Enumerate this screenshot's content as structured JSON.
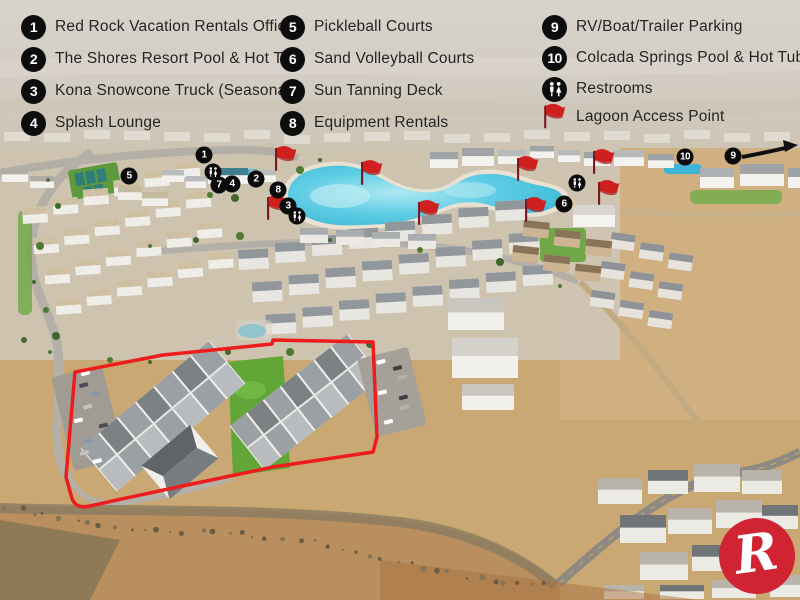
{
  "legend": {
    "items": [
      {
        "num": "1",
        "label": "Red Rock Vacation Rentals Office"
      },
      {
        "num": "2",
        "label": "The Shores Resort Pool & Hot Tub"
      },
      {
        "num": "3",
        "label": "Kona Snowcone Truck (Seasonal)"
      },
      {
        "num": "4",
        "label": "Splash Lounge"
      },
      {
        "num": "5",
        "label": "Pickleball Courts"
      },
      {
        "num": "6",
        "label": "Sand Volleyball Courts"
      },
      {
        "num": "7",
        "label": "Sun Tanning Deck"
      },
      {
        "num": "8",
        "label": "Equipment Rentals"
      },
      {
        "num": "9",
        "label": "RV/Boat/Trailer Parking"
      },
      {
        "num": "10",
        "label": "Colcada Springs Pool & Hot Tubs"
      },
      {
        "icon": "restroom",
        "label": "Restrooms"
      },
      {
        "icon": "flag",
        "label": "Lagoon Access Point"
      }
    ]
  },
  "map": {
    "markers": [
      {
        "label": "1",
        "x": 204,
        "y": 155
      },
      {
        "label": "2",
        "x": 256,
        "y": 179
      },
      {
        "label": "3",
        "x": 288,
        "y": 206
      },
      {
        "label": "4",
        "x": 232,
        "y": 184
      },
      {
        "label": "5",
        "x": 129,
        "y": 176
      },
      {
        "label": "6",
        "x": 564,
        "y": 204
      },
      {
        "label": "7",
        "x": 219,
        "y": 185
      },
      {
        "label": "8",
        "x": 278,
        "y": 190
      },
      {
        "label": "9",
        "x": 733,
        "y": 156
      },
      {
        "label": "10",
        "x": 685,
        "y": 157
      },
      {
        "type": "restroom",
        "x": 213,
        "y": 172
      },
      {
        "type": "restroom",
        "x": 297,
        "y": 216
      },
      {
        "type": "restroom",
        "x": 577,
        "y": 183
      }
    ],
    "flags": [
      {
        "x": 276,
        "y": 148
      },
      {
        "x": 268,
        "y": 197
      },
      {
        "x": 362,
        "y": 162
      },
      {
        "x": 419,
        "y": 202
      },
      {
        "x": 518,
        "y": 158
      },
      {
        "x": 594,
        "y": 151
      },
      {
        "x": 599,
        "y": 182
      },
      {
        "x": 526,
        "y": 199
      }
    ],
    "arrow": {
      "from": [
        742,
        157
      ],
      "to": [
        793,
        146
      ]
    }
  },
  "logo": {
    "letter": "R"
  },
  "colors": {
    "badge_black": "#0d0d0d",
    "flag_red": "#cf1f1f",
    "outline_red": "#ee1c1c",
    "lagoon_blue": "#45c4de",
    "logo_red": "#d02433"
  }
}
